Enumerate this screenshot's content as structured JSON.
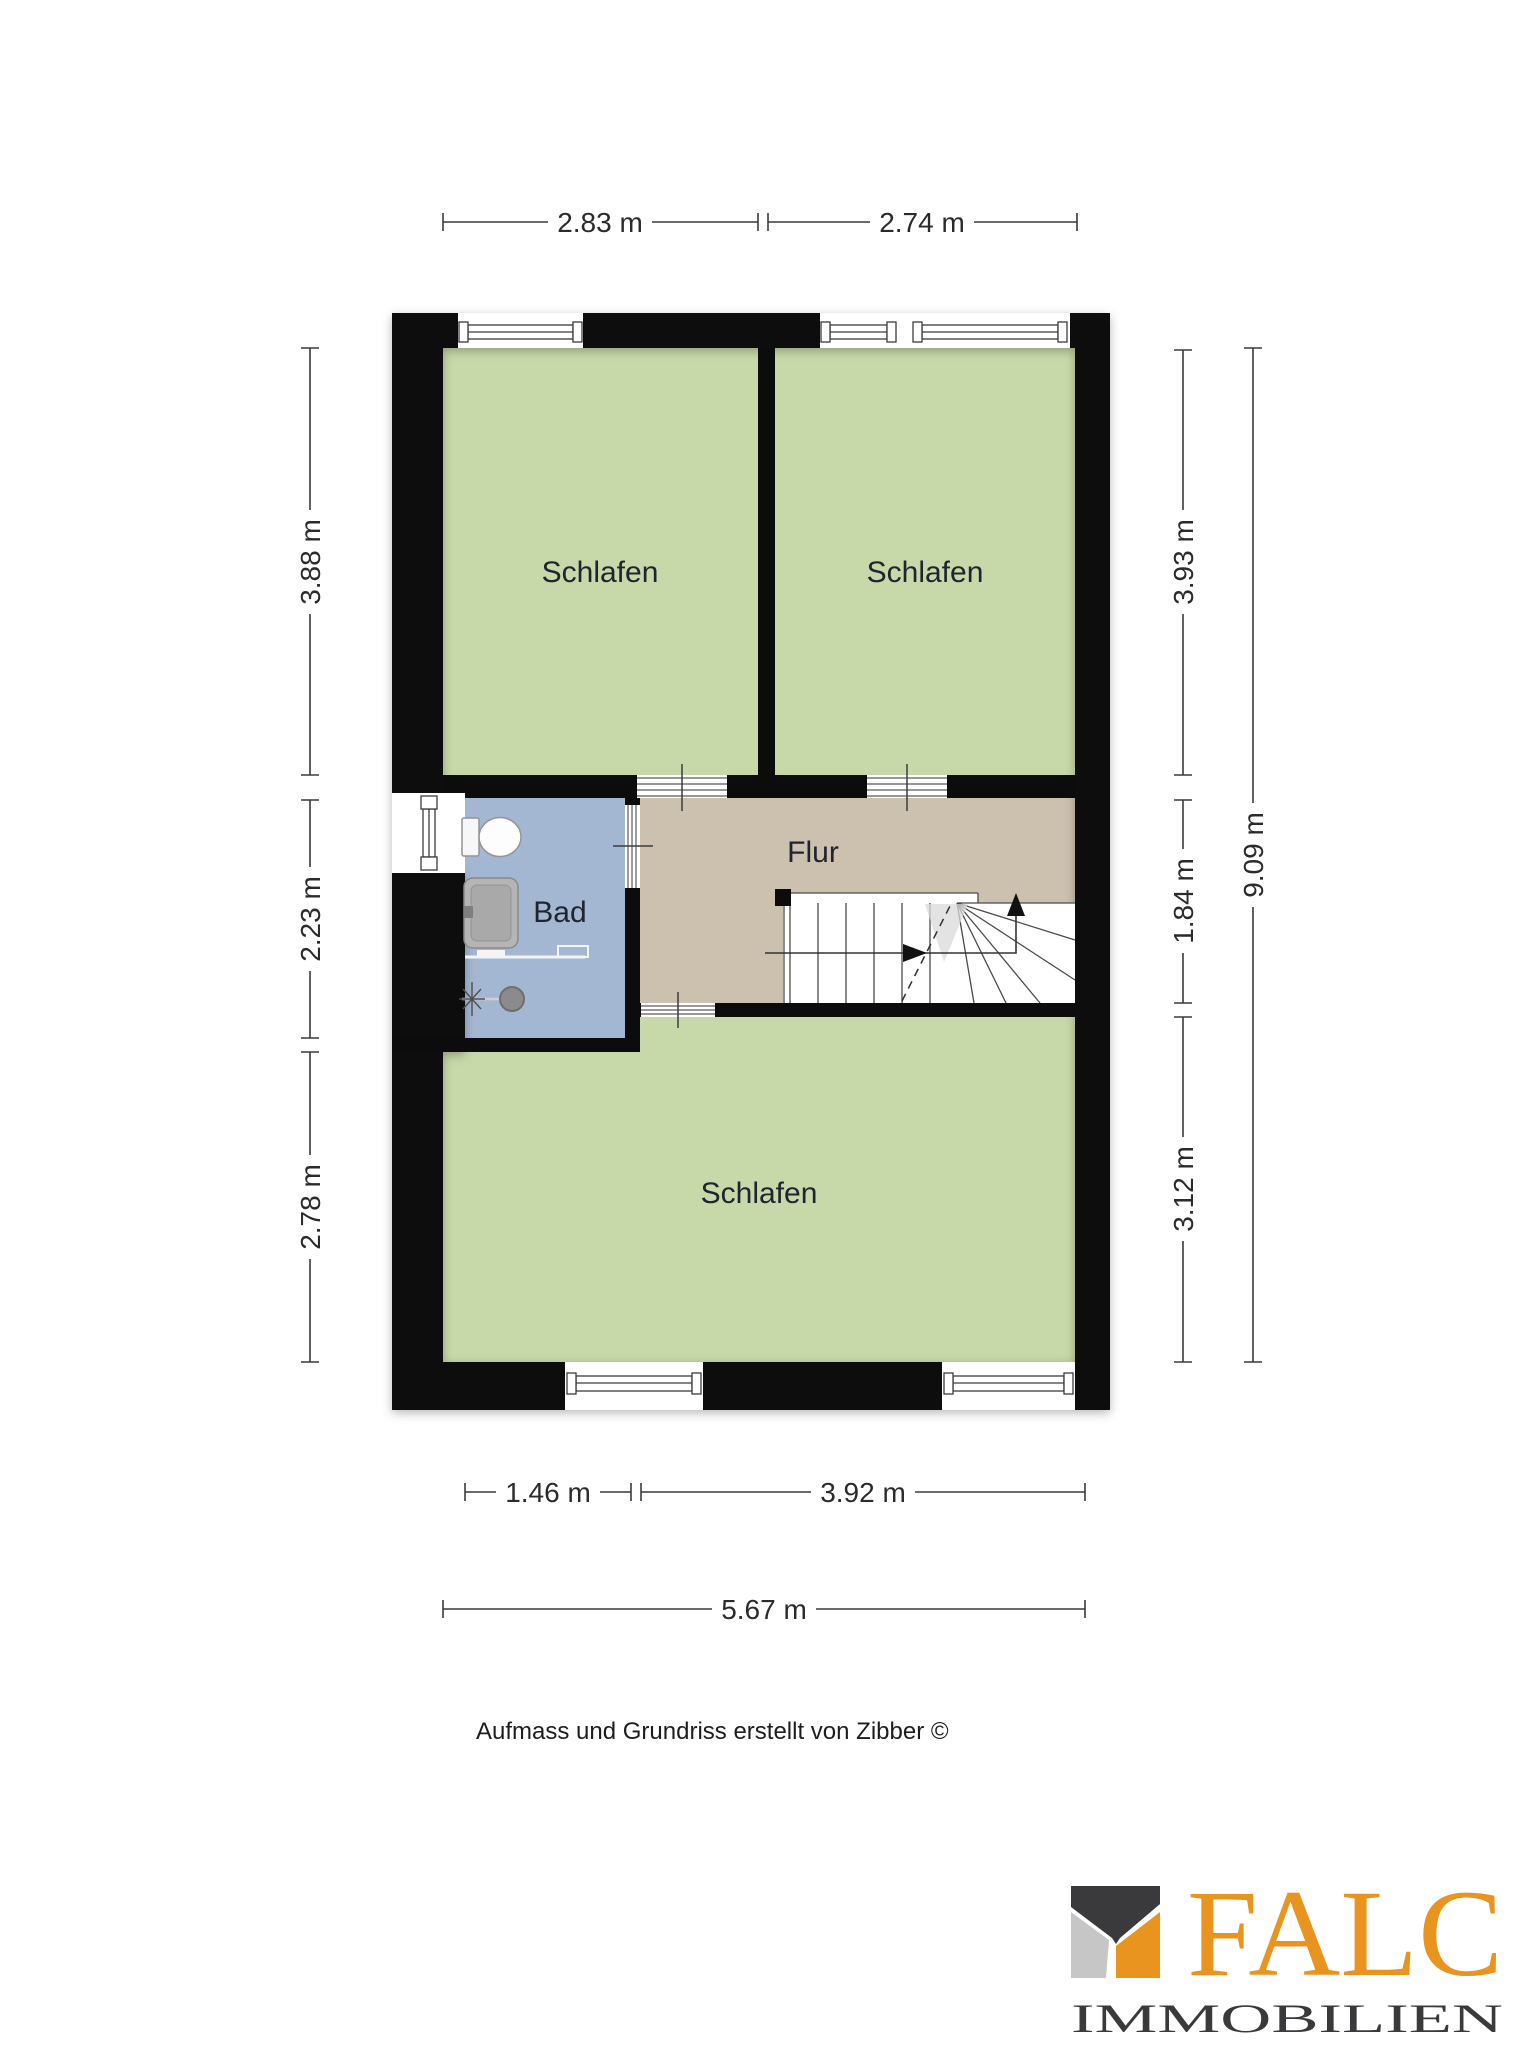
{
  "caption": "Aufmass und Grundriss erstellt von Zibber ©",
  "rooms": {
    "bedroom_top_left": {
      "label": "Schlafen",
      "color": "#c7d9a9"
    },
    "bedroom_top_right": {
      "label": "Schlafen",
      "color": "#c7d9a9"
    },
    "bedroom_bottom": {
      "label": "Schlafen",
      "color": "#c7d9a9"
    },
    "bathroom": {
      "label": "Bad",
      "color": "#a4b7d2"
    },
    "hallway": {
      "label": "Flur",
      "color": "#ccc0af"
    }
  },
  "dimensions": {
    "top": [
      "2.83 m",
      "2.74 m"
    ],
    "left": [
      "3.88 m",
      "2.23 m",
      "2.78 m"
    ],
    "right": [
      "3.93 m",
      "1.84 m",
      "3.12 m"
    ],
    "right_overall": "9.09 m",
    "bottom": [
      "1.46 m",
      "3.92 m"
    ],
    "bottom_overall": "5.67 m"
  },
  "logo": {
    "brand": "FALC",
    "subtitle": "IMMOBILIEN",
    "orange": "#e8941f",
    "charcoal": "#3a3a3c",
    "gray": "#c6c6c6"
  },
  "colors": {
    "wall": "#0c0c0c",
    "dim_text": "#2b2b2b",
    "label_text": "#20242f"
  }
}
